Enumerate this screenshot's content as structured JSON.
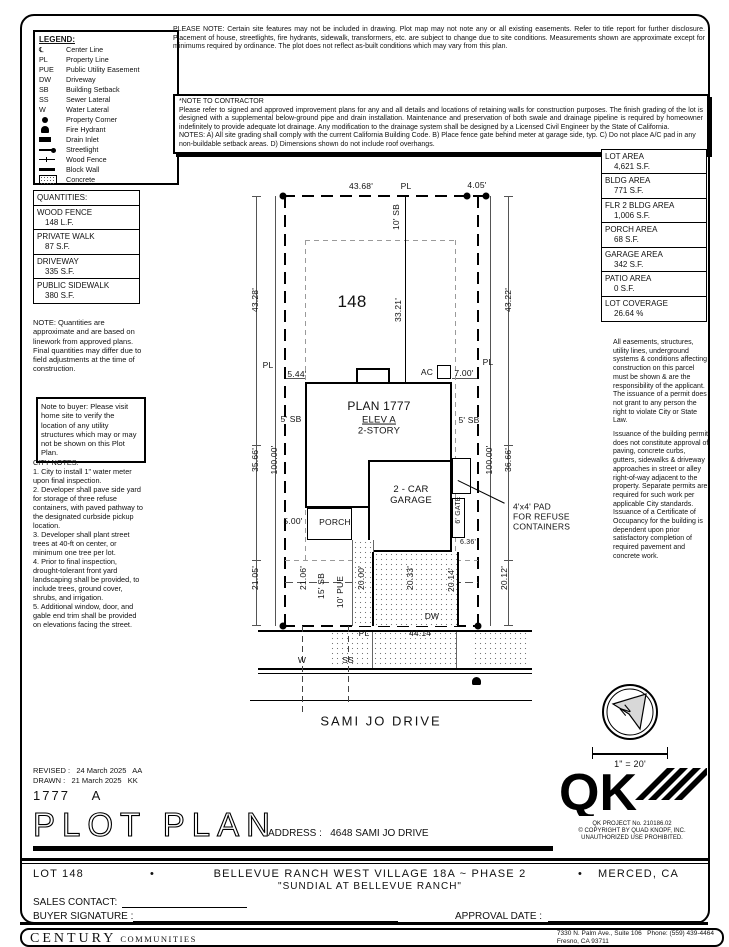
{
  "legend": {
    "title": "LEGEND:",
    "items": [
      {
        "type": "text",
        "symbol": "℄",
        "label": "Center Line"
      },
      {
        "type": "text",
        "symbol": "PL",
        "label": "Property Line"
      },
      {
        "type": "text",
        "symbol": "PUE",
        "label": "Public Utility Easement"
      },
      {
        "type": "text",
        "symbol": "DW",
        "label": "Driveway"
      },
      {
        "type": "text",
        "symbol": "SB",
        "label": "Building Setback"
      },
      {
        "type": "text",
        "symbol": "SS",
        "label": "Sewer Lateral"
      },
      {
        "type": "text",
        "symbol": "W",
        "label": "Water Lateral"
      },
      {
        "type": "dot",
        "symbol": "",
        "label": "Property Corner"
      },
      {
        "type": "hydrant",
        "symbol": "",
        "label": "Fire Hydrant"
      },
      {
        "type": "drain",
        "symbol": "",
        "label": "Drain Inlet"
      },
      {
        "type": "streetlight",
        "symbol": "",
        "label": "Streetlight"
      },
      {
        "type": "fence",
        "symbol": "",
        "label": "Wood Fence"
      },
      {
        "type": "wall",
        "symbol": "",
        "label": "Block Wall"
      },
      {
        "type": "concrete",
        "symbol": "",
        "label": "Concrete"
      }
    ]
  },
  "please_note": "PLEASE NOTE:  Certain site features may not be included in drawing. Plot map may not note any or all existing easements. Refer to title report for further disclosure. Placement of house, streetlights, fire hydrants, sidewalk, transformers, etc. are subject to change due to site conditions. Measurements shown are approximate except for minimums required by ordinance. The plot does not reflect as-built conditions which may vary from this plan.",
  "note_to_contractor": {
    "title": "*NOTE TO CONTRACTOR",
    "body": "Please refer to signed and approved improvement plans for any and all details and locations of retaining walls for construction purposes. The finish grading of the lot is designed with a supplemental below-ground pipe and drain installation. Maintenance and preservation of both swale and drainage pipeline is required by homeowner indefinitely to provide adequate lot drainage. Any modification to the drainage system shall be designed by a Licensed Civil Engineer by the State of California.",
    "notes": "NOTES:  A) All site grading shall comply with the current California Building Code.  B) Place fence gate behind meter at garage side, typ. C) Do not place A/C pad in any non-buildable setback areas.  D) Dimensions shown do not include roof overhangs."
  },
  "quantities": {
    "title": "QUANTITIES:",
    "items": [
      {
        "name": "WOOD FENCE",
        "value": "148 L.F."
      },
      {
        "name": "PRIVATE WALK",
        "value": "87 S.F."
      },
      {
        "name": "DRIVEWAY",
        "value": "335 S.F."
      },
      {
        "name": "PUBLIC SIDEWALK",
        "value": "380 S.F."
      }
    ],
    "note": "NOTE: Quantities are approximate and are based on linework from approved plans.  Final quantities may differ due to field adjustments at the time of construction."
  },
  "buyer_note": "Note to buyer: Please visit home site to verify the location of any utility structures which may or may not be shown on this Plot Plan.",
  "city_notes": {
    "title": "CITY NOTES:",
    "items": [
      "1. City to install 1\" water meter upon final inspection.",
      "2. Developer shall pave side yard for storage of three refuse containers, with paved pathway to the designated curbside pickup location.",
      "3. Developer shall plant street trees at 40-ft on center, or minimum one tree per lot.",
      "4. Prior to final inspection, drought-tolerant front yard landscaping shall be provided, to include trees, ground cover, shrubs, and irrigation.",
      "5. Additional window, door, and gable end trim shall be provided on elevations facing the street."
    ]
  },
  "areas": [
    {
      "name": "LOT AREA",
      "value": "4,621 S.F."
    },
    {
      "name": "BLDG AREA",
      "value": "771 S.F."
    },
    {
      "name": "FLR 2 BLDG AREA",
      "value": "1,006 S.F."
    },
    {
      "name": "PORCH AREA",
      "value": "68 S.F."
    },
    {
      "name": "GARAGE AREA",
      "value": "342 S.F."
    },
    {
      "name": "PATIO AREA",
      "value": "0 S.F."
    },
    {
      "name": "LOT COVERAGE",
      "value": "26.64 %"
    }
  ],
  "easements_note": "All easements, structures, utility lines, underground systems & conditions affecting construction on this parcel must be shown & are the responsibility of the applicant. The issuance of a permit does not grant to any person the right to violate City or State Law.",
  "permit_note": "Issuance of the building permit does not constitute approval of paving, concrete curbs, gutters, sidewalks & driveway approaches in street or alley right-of-way adjacent to the property. Separate permits are required for such work per applicable City standards. Issuance of a Certificate of Occupancy for the building is dependent upon prior satisfactory completion of required pavement and concrete work.",
  "plan": {
    "north_label": "N",
    "labels": [
      {
        "t": "43.68'",
        "x": 361,
        "y": 187
      },
      {
        "t": "PL",
        "x": 406,
        "y": 187
      },
      {
        "t": "4.05'",
        "x": 477,
        "y": 186
      },
      {
        "t": "10' SB",
        "x": 397,
        "y": 217,
        "r": 1
      },
      {
        "t": "33.21'",
        "x": 399,
        "y": 310,
        "r": 1
      },
      {
        "t": "148",
        "x": 352,
        "y": 302,
        "s": 17,
        "n": "lot-number-label"
      },
      {
        "t": "43.28'",
        "x": 256,
        "y": 300,
        "r": 1
      },
      {
        "t": "35.66'",
        "x": 256,
        "y": 460,
        "r": 1
      },
      {
        "t": "21.05'",
        "x": 256,
        "y": 578,
        "r": 1
      },
      {
        "t": "100.00'",
        "x": 275,
        "y": 460,
        "r": 1
      },
      {
        "t": "43.22'",
        "x": 509,
        "y": 300,
        "r": 1
      },
      {
        "t": "36.66'",
        "x": 509,
        "y": 460,
        "r": 1
      },
      {
        "t": "20.12'",
        "x": 505,
        "y": 578,
        "r": 1
      },
      {
        "t": "100.00'",
        "x": 490,
        "y": 460,
        "r": 1
      },
      {
        "t": "PL",
        "x": 268,
        "y": 366
      },
      {
        "t": "5.44'",
        "x": 297,
        "y": 375
      },
      {
        "t": "AC",
        "x": 427,
        "y": 373
      },
      {
        "t": "7.00'",
        "x": 464,
        "y": 374
      },
      {
        "t": "PL",
        "x": 488,
        "y": 363
      },
      {
        "t": "5' SB",
        "x": 291,
        "y": 420
      },
      {
        "t": "5' SB",
        "x": 469,
        "y": 421
      },
      {
        "t": "PLAN 1777",
        "x": 379,
        "y": 407,
        "s": 12,
        "n": "plan-name-label"
      },
      {
        "t": "ELEV A",
        "x": 379,
        "y": 421,
        "s": 9.5,
        "u": 1
      },
      {
        "t": "2-STORY",
        "x": 379,
        "y": 432,
        "s": 9.5
      },
      {
        "t": "2 - CAR\nGARAGE",
        "x": 411,
        "y": 496,
        "s": 9.5,
        "n": "garage-label"
      },
      {
        "t": "PORCH",
        "x": 335,
        "y": 523,
        "n": "porch-label"
      },
      {
        "t": "5.00'",
        "x": 293,
        "y": 522
      },
      {
        "t": "6' GATE",
        "x": 459,
        "y": 510,
        "r": 1,
        "s": 7
      },
      {
        "t": "6.36'",
        "x": 468,
        "y": 543,
        "s": 7
      },
      {
        "t": "4'x4' PAD\nFOR REFUSE\nCONTAINERS",
        "x": 513,
        "y": 517,
        "a": "l",
        "n": "refuse-callout"
      },
      {
        "t": "21.06'",
        "x": 304,
        "y": 578,
        "r": 1
      },
      {
        "t": "15' SB",
        "x": 322,
        "y": 586,
        "r": 1
      },
      {
        "t": "10' PUE",
        "x": 341,
        "y": 592,
        "r": 1
      },
      {
        "t": "20.00'",
        "x": 362,
        "y": 578,
        "r": 1
      },
      {
        "t": "20.33'",
        "x": 411,
        "y": 578,
        "r": 1
      },
      {
        "t": "20.14'",
        "x": 452,
        "y": 580,
        "r": 1
      },
      {
        "t": "DW",
        "x": 432,
        "y": 617
      },
      {
        "t": "PL",
        "x": 364,
        "y": 634
      },
      {
        "t": "44.14'",
        "x": 421,
        "y": 634
      },
      {
        "t": "W",
        "x": 302,
        "y": 661
      },
      {
        "t": "SS",
        "x": 348,
        "y": 661
      },
      {
        "t": "SAMI JO DRIVE",
        "x": 381,
        "y": 722,
        "s": 13,
        "ls": 2,
        "n": "street-name-label"
      },
      {
        "t": "1\" = 20'",
        "x": 630,
        "y": 764,
        "s": 9,
        "n": "scale-label"
      }
    ]
  },
  "titleblock": {
    "revised": "REVISED :   24 March 2025   AA",
    "drawn": "DRAWN :   21 March 2025   KK",
    "plan_number": "1777    A",
    "title": "PLOT PLAN",
    "address_line": "ADDRESS :   4648 SAMI JO DRIVE",
    "qk_logo_text": "QK",
    "qk_project": "QK PROJECT No. 210186.02",
    "qk_copyright1": "© COPYRIGHT BY QUAD KNOPF, INC.",
    "qk_copyright2": "UNAUTHORIZED USE PROHIBITED.",
    "lot_label": "LOT 148",
    "bullet": "•",
    "community_line": "BELLEVUE RANCH WEST VILLAGE 18A ~ PHASE 2",
    "city_label": "MERCED, CA",
    "subdivision": "\"SUNDIAL AT BELLEVUE RANCH\"",
    "sales_contact_label": "SALES CONTACT:",
    "buyer_signature_label": "BUYER SIGNATURE :",
    "approval_date_label": "APPROVAL DATE :"
  },
  "footer": {
    "brand_main": "CENTURY",
    "brand_sub": "COMMUNITIES",
    "address_street": "7330 N. Palm Ave., Suite 106",
    "address_phone": "Phone:  (559) 439-4464",
    "address_city": "Fresno, CA  93711"
  }
}
